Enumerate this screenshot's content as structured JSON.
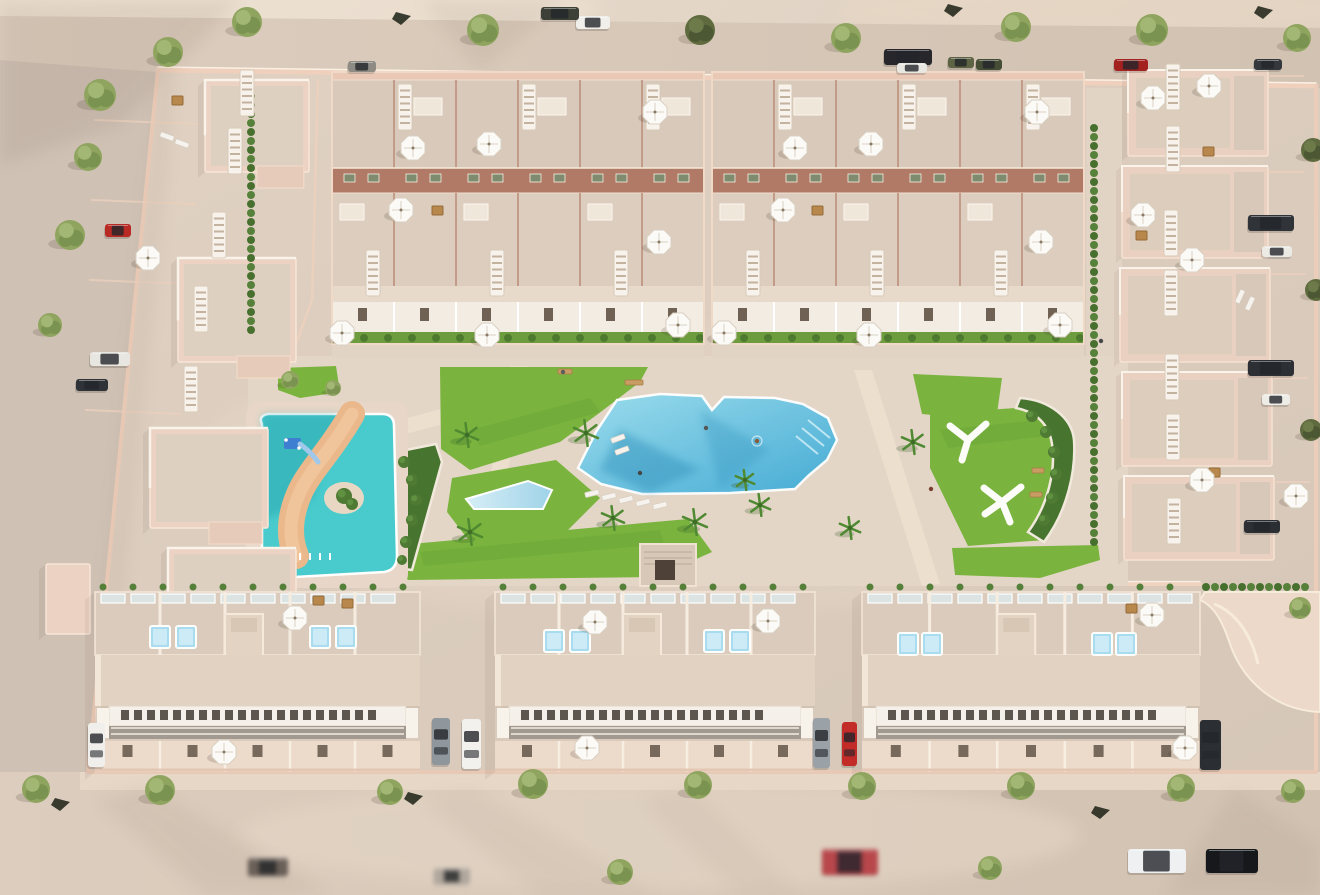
{
  "meta": {
    "description": "Aerial 3D render of a beige-pink residential complex: perimeter streets with parked cars and trees, two top townhouse blocks, left apartment cluster, right villa column, central park with lagoon pool, lap pool, kids splash pool with lazy river, playground shade structures, and three long bottom townhouse blocks with roof terraces"
  },
  "scene": {
    "palette": {
      "sand": "#e2d3c4",
      "ground": "#dbccbd",
      "roadside": "#cfc1b4",
      "wallPink": "#eed0bc",
      "building": "#ebd2c2",
      "roof": "#ddcebe",
      "terrace": "#d8c9ba",
      "band": "#b07a66",
      "lawn": "#7ab43e",
      "shrub": "#4e7a2f",
      "poolBlue": "#45abd4",
      "kidsPool": "#49cbcd",
      "river": "#eab88b",
      "white": "#f7f3ec"
    },
    "shadowPatches": [
      {
        "pts": "0,0 240,0 120,125 0,165",
        "o": 0.1
      },
      {
        "pts": "420,0 565,0 480,72",
        "o": 0.08
      },
      {
        "pts": "158,74 176,74 120,640 100,620",
        "o": 0.07
      },
      {
        "pts": "150,785 330,895 205,895 95,800",
        "o": 0.07
      },
      {
        "pts": "470,788 660,895 540,895 420,798",
        "o": 0.06
      },
      {
        "pts": "690,788 800,895 740,895 640,800",
        "o": 0.05
      },
      {
        "pts": "1235,788 1320,845 1320,895 1165,895",
        "o": 0.07
      }
    ],
    "apartments": [
      {
        "x": 205,
        "y": 80,
        "w": 104,
        "h": 92
      },
      {
        "x": 178,
        "y": 258,
        "w": 118,
        "h": 104
      },
      {
        "x": 150,
        "y": 428,
        "w": 118,
        "h": 100
      },
      {
        "x": 168,
        "y": 548,
        "w": 128,
        "h": 86
      },
      {
        "x": 46,
        "y": 564,
        "w": 44,
        "h": 70,
        "plain": 1
      }
    ],
    "villas": [
      {
        "x": 1128,
        "y": 70,
        "w": 140,
        "h": 86
      },
      {
        "x": 1122,
        "y": 166,
        "w": 146,
        "h": 92
      },
      {
        "x": 1120,
        "y": 268,
        "w": 150,
        "h": 94
      },
      {
        "x": 1122,
        "y": 372,
        "w": 150,
        "h": 94
      },
      {
        "x": 1124,
        "y": 476,
        "w": 150,
        "h": 84
      }
    ],
    "topBlocks": [
      {
        "x": 332,
        "w": 372,
        "units": 6
      },
      {
        "x": 712,
        "w": 372,
        "units": 6
      }
    ],
    "bottomBlocks": [
      {
        "x": 95,
        "w": 325
      },
      {
        "x": 495,
        "w": 320
      },
      {
        "x": 862,
        "w": 338
      }
    ],
    "hedges": [
      {
        "x": 251,
        "y": 96,
        "len": 250,
        "dir": "v"
      },
      {
        "x": 1094,
        "y": 128,
        "len": 430,
        "dir": "v"
      },
      {
        "x": 1206,
        "y": 587,
        "len": 110,
        "dir": "h"
      }
    ],
    "ladders": [
      {
        "x": 240,
        "y": 70
      },
      {
        "x": 228,
        "y": 128
      },
      {
        "x": 212,
        "y": 212
      },
      {
        "x": 194,
        "y": 286
      },
      {
        "x": 184,
        "y": 366
      },
      {
        "x": 398,
        "y": 84
      },
      {
        "x": 522,
        "y": 84
      },
      {
        "x": 646,
        "y": 84
      },
      {
        "x": 366,
        "y": 250
      },
      {
        "x": 490,
        "y": 250
      },
      {
        "x": 614,
        "y": 250
      },
      {
        "x": 778,
        "y": 84
      },
      {
        "x": 902,
        "y": 84
      },
      {
        "x": 1026,
        "y": 84
      },
      {
        "x": 746,
        "y": 250
      },
      {
        "x": 870,
        "y": 250
      },
      {
        "x": 994,
        "y": 250
      },
      {
        "x": 1166,
        "y": 64
      },
      {
        "x": 1166,
        "y": 126
      },
      {
        "x": 1164,
        "y": 210
      },
      {
        "x": 1164,
        "y": 270
      },
      {
        "x": 1165,
        "y": 354
      },
      {
        "x": 1166,
        "y": 414
      },
      {
        "x": 1167,
        "y": 498
      }
    ],
    "umbrellas": [
      {
        "x": 148,
        "y": 258
      },
      {
        "x": 413,
        "y": 148
      },
      {
        "x": 489,
        "y": 144
      },
      {
        "x": 401,
        "y": 210
      },
      {
        "x": 655,
        "y": 112
      },
      {
        "x": 659,
        "y": 242
      },
      {
        "x": 342,
        "y": 333
      },
      {
        "x": 487,
        "y": 335
      },
      {
        "x": 678,
        "y": 325
      },
      {
        "x": 795,
        "y": 148
      },
      {
        "x": 871,
        "y": 144
      },
      {
        "x": 783,
        "y": 210
      },
      {
        "x": 1037,
        "y": 112
      },
      {
        "x": 1041,
        "y": 242
      },
      {
        "x": 724,
        "y": 333
      },
      {
        "x": 869,
        "y": 335
      },
      {
        "x": 1060,
        "y": 325
      },
      {
        "x": 1209,
        "y": 86
      },
      {
        "x": 1153,
        "y": 98
      },
      {
        "x": 1143,
        "y": 215
      },
      {
        "x": 1192,
        "y": 260
      },
      {
        "x": 1202,
        "y": 480
      },
      {
        "x": 1296,
        "y": 496
      },
      {
        "x": 295,
        "y": 618
      },
      {
        "x": 224,
        "y": 752
      },
      {
        "x": 595,
        "y": 622
      },
      {
        "x": 768,
        "y": 621
      },
      {
        "x": 587,
        "y": 748
      },
      {
        "x": 1152,
        "y": 615
      },
      {
        "x": 1185,
        "y": 748
      }
    ],
    "jacuzzis": [
      {
        "x": 150,
        "y": 626
      },
      {
        "x": 176,
        "y": 626
      },
      {
        "x": 310,
        "y": 626
      },
      {
        "x": 336,
        "y": 626
      },
      {
        "x": 544,
        "y": 630
      },
      {
        "x": 570,
        "y": 630
      },
      {
        "x": 704,
        "y": 630
      },
      {
        "x": 730,
        "y": 630
      },
      {
        "x": 898,
        "y": 633
      },
      {
        "x": 922,
        "y": 633
      },
      {
        "x": 1092,
        "y": 633
      },
      {
        "x": 1116,
        "y": 633
      }
    ],
    "loungers": [
      {
        "x": 585,
        "y": 491,
        "a": -14
      },
      {
        "x": 602,
        "y": 494,
        "a": -14
      },
      {
        "x": 619,
        "y": 497,
        "a": -14
      },
      {
        "x": 636,
        "y": 500,
        "a": -14
      },
      {
        "x": 653,
        "y": 503,
        "a": -14
      },
      {
        "x": 611,
        "y": 436,
        "a": -20
      },
      {
        "x": 615,
        "y": 448,
        "a": -20
      },
      {
        "x": 160,
        "y": 134,
        "a": 20
      },
      {
        "x": 175,
        "y": 141,
        "a": 20
      },
      {
        "x": 1233,
        "y": 294,
        "a": -65
      },
      {
        "x": 1243,
        "y": 301,
        "a": -65
      }
    ],
    "tables": [
      {
        "x": 172,
        "y": 96
      },
      {
        "x": 1203,
        "y": 147
      },
      {
        "x": 1136,
        "y": 231
      },
      {
        "x": 1209,
        "y": 468
      },
      {
        "x": 313,
        "y": 596
      },
      {
        "x": 342,
        "y": 599
      },
      {
        "x": 1126,
        "y": 604
      },
      {
        "x": 432,
        "y": 206
      },
      {
        "x": 812,
        "y": 206
      }
    ],
    "benches": [
      {
        "x": 625,
        "y": 380,
        "w": 18
      },
      {
        "x": 558,
        "y": 369,
        "w": 14
      },
      {
        "x": 1032,
        "y": 468,
        "w": 12
      },
      {
        "x": 1030,
        "y": 492,
        "w": 12
      }
    ],
    "people": [
      {
        "x": 757,
        "y": 441,
        "c": "#8a5a3a",
        "pool": 1
      },
      {
        "x": 640,
        "y": 473,
        "c": "#454545"
      },
      {
        "x": 563,
        "y": 372,
        "c": "#5d5d5d"
      },
      {
        "x": 706,
        "y": 428,
        "c": "#555555"
      },
      {
        "x": 931,
        "y": 489,
        "c": "#7a3f2f"
      },
      {
        "x": 1101,
        "y": 341,
        "c": "#474747"
      }
    ],
    "darkPlants": [
      {
        "x": 396,
        "y": 12
      },
      {
        "x": 948,
        "y": 4
      },
      {
        "x": 1258,
        "y": 6
      },
      {
        "x": 55,
        "y": 798
      },
      {
        "x": 408,
        "y": 792
      },
      {
        "x": 1095,
        "y": 806
      }
    ],
    "trees": [
      {
        "x": 168,
        "y": 52,
        "r": 15,
        "v": "g"
      },
      {
        "x": 247,
        "y": 22,
        "r": 15,
        "v": "g"
      },
      {
        "x": 483,
        "y": 30,
        "r": 16,
        "v": "g"
      },
      {
        "x": 700,
        "y": 30,
        "r": 15,
        "v": "d"
      },
      {
        "x": 846,
        "y": 38,
        "r": 15,
        "v": "g"
      },
      {
        "x": 1016,
        "y": 27,
        "r": 15,
        "v": "g"
      },
      {
        "x": 1152,
        "y": 30,
        "r": 16,
        "v": "g"
      },
      {
        "x": 1297,
        "y": 38,
        "r": 14,
        "v": "g"
      },
      {
        "x": 100,
        "y": 95,
        "r": 16,
        "v": "g"
      },
      {
        "x": 88,
        "y": 157,
        "r": 14,
        "v": "g"
      },
      {
        "x": 70,
        "y": 235,
        "r": 15,
        "v": "g"
      },
      {
        "x": 50,
        "y": 325,
        "r": 12,
        "v": "g"
      },
      {
        "x": 36,
        "y": 789,
        "r": 14,
        "v": "g"
      },
      {
        "x": 160,
        "y": 790,
        "r": 15,
        "v": "g"
      },
      {
        "x": 390,
        "y": 792,
        "r": 13,
        "v": "g"
      },
      {
        "x": 533,
        "y": 784,
        "r": 15,
        "v": "g"
      },
      {
        "x": 698,
        "y": 785,
        "r": 14,
        "v": "g"
      },
      {
        "x": 862,
        "y": 786,
        "r": 14,
        "v": "g"
      },
      {
        "x": 1021,
        "y": 786,
        "r": 14,
        "v": "g"
      },
      {
        "x": 1181,
        "y": 788,
        "r": 14,
        "v": "g"
      },
      {
        "x": 1293,
        "y": 791,
        "r": 12,
        "v": "g"
      },
      {
        "x": 620,
        "y": 872,
        "r": 13,
        "v": "g"
      },
      {
        "x": 990,
        "y": 868,
        "r": 12,
        "v": "g"
      },
      {
        "x": 1313,
        "y": 150,
        "r": 12,
        "v": "d"
      },
      {
        "x": 1316,
        "y": 290,
        "r": 11,
        "v": "d"
      },
      {
        "x": 1311,
        "y": 430,
        "r": 11,
        "v": "d"
      },
      {
        "x": 1300,
        "y": 608,
        "r": 11,
        "v": "g"
      },
      {
        "x": 290,
        "y": 380,
        "r": 9,
        "v": "g"
      },
      {
        "x": 333,
        "y": 388,
        "r": 8,
        "v": "g"
      },
      {
        "x": 586,
        "y": 433,
        "r": 13,
        "v": "p"
      },
      {
        "x": 467,
        "y": 435,
        "r": 12,
        "v": "p"
      },
      {
        "x": 470,
        "y": 532,
        "r": 13,
        "v": "p"
      },
      {
        "x": 613,
        "y": 518,
        "r": 12,
        "v": "p"
      },
      {
        "x": 695,
        "y": 522,
        "r": 13,
        "v": "p"
      },
      {
        "x": 850,
        "y": 528,
        "r": 11,
        "v": "p"
      },
      {
        "x": 913,
        "y": 442,
        "r": 12,
        "v": "p"
      },
      {
        "x": 745,
        "y": 480,
        "r": 10,
        "v": "p"
      },
      {
        "x": 760,
        "y": 505,
        "r": 11,
        "v": "p"
      },
      {
        "x": 344,
        "y": 496,
        "r": 8,
        "v": "b"
      },
      {
        "x": 352,
        "y": 504,
        "r": 6,
        "v": "b"
      },
      {
        "x": 1032,
        "y": 416,
        "r": 6,
        "v": "b"
      },
      {
        "x": 1046,
        "y": 432,
        "r": 6,
        "v": "b"
      },
      {
        "x": 1054,
        "y": 452,
        "r": 6,
        "v": "b"
      },
      {
        "x": 1056,
        "y": 474,
        "r": 6,
        "v": "b"
      },
      {
        "x": 1052,
        "y": 498,
        "r": 6,
        "v": "b"
      },
      {
        "x": 1044,
        "y": 520,
        "r": 6,
        "v": "b"
      },
      {
        "x": 404,
        "y": 462,
        "r": 6,
        "v": "b"
      },
      {
        "x": 412,
        "y": 480,
        "r": 6,
        "v": "b"
      },
      {
        "x": 416,
        "y": 500,
        "r": 6,
        "v": "b"
      },
      {
        "x": 412,
        "y": 520,
        "r": 6,
        "v": "b"
      },
      {
        "x": 406,
        "y": 542,
        "r": 6,
        "v": "b"
      },
      {
        "x": 402,
        "y": 560,
        "r": 5,
        "v": "b"
      }
    ],
    "cars": [
      {
        "x": 576,
        "y": 16,
        "w": 34,
        "h": 13,
        "c": "#f0efeb"
      },
      {
        "x": 541,
        "y": 7,
        "w": 38,
        "h": 13,
        "c": "#3c4036"
      },
      {
        "x": 884,
        "y": 49,
        "w": 48,
        "h": 16,
        "c": "#26262b"
      },
      {
        "x": 897,
        "y": 63,
        "w": 30,
        "h": 10,
        "c": "#e9e7e2"
      },
      {
        "x": 948,
        "y": 57,
        "w": 26,
        "h": 11,
        "c": "#5d6343"
      },
      {
        "x": 976,
        "y": 59,
        "w": 26,
        "h": 11,
        "c": "#454d34"
      },
      {
        "x": 1114,
        "y": 59,
        "w": 34,
        "h": 12,
        "c": "#a32220"
      },
      {
        "x": 1254,
        "y": 59,
        "w": 28,
        "h": 11,
        "c": "#34373c"
      },
      {
        "x": 348,
        "y": 61,
        "w": 28,
        "h": 11,
        "c": "#8e8b84"
      },
      {
        "x": 105,
        "y": 224,
        "w": 26,
        "h": 13,
        "c": "#b92a25"
      },
      {
        "x": 90,
        "y": 352,
        "w": 40,
        "h": 14,
        "c": "#e8e6e1"
      },
      {
        "x": 76,
        "y": 379,
        "w": 32,
        "h": 12,
        "c": "#2f3237"
      },
      {
        "x": 1248,
        "y": 215,
        "w": 46,
        "h": 16,
        "c": "#303338"
      },
      {
        "x": 1262,
        "y": 246,
        "w": 30,
        "h": 11,
        "c": "#eceae5"
      },
      {
        "x": 1248,
        "y": 360,
        "w": 46,
        "h": 16,
        "c": "#2c2f34"
      },
      {
        "x": 1262,
        "y": 394,
        "w": 28,
        "h": 11,
        "c": "#eeece7"
      },
      {
        "x": 1244,
        "y": 520,
        "w": 36,
        "h": 13,
        "c": "#2b2e33"
      },
      {
        "x": 88,
        "y": 723,
        "w": 17,
        "h": 44,
        "c": "#f0efec",
        "o": "v"
      },
      {
        "x": 432,
        "y": 718,
        "w": 18,
        "h": 47,
        "c": "#8f969c",
        "o": "v"
      },
      {
        "x": 462,
        "y": 719,
        "w": 19,
        "h": 50,
        "c": "#f2f1ee",
        "o": "v"
      },
      {
        "x": 813,
        "y": 718,
        "w": 17,
        "h": 50,
        "c": "#9aa1a7",
        "o": "v"
      },
      {
        "x": 842,
        "y": 722,
        "w": 15,
        "h": 44,
        "c": "#c32b28",
        "o": "v"
      },
      {
        "x": 1200,
        "y": 720,
        "w": 21,
        "h": 50,
        "c": "#2b2e33",
        "o": "v"
      },
      {
        "x": 822,
        "y": 849,
        "w": 56,
        "h": 26,
        "c": "#b8474b",
        "blur": 1
      },
      {
        "x": 1128,
        "y": 849,
        "w": 58,
        "h": 24,
        "c": "#eff0f2"
      },
      {
        "x": 1206,
        "y": 849,
        "w": 52,
        "h": 24,
        "c": "#17181c"
      },
      {
        "x": 248,
        "y": 858,
        "w": 40,
        "h": 18,
        "c": "#6b6058",
        "blur": 1
      },
      {
        "x": 434,
        "y": 868,
        "w": 36,
        "h": 16,
        "c": "#b0a79d",
        "blur": 1
      }
    ]
  }
}
